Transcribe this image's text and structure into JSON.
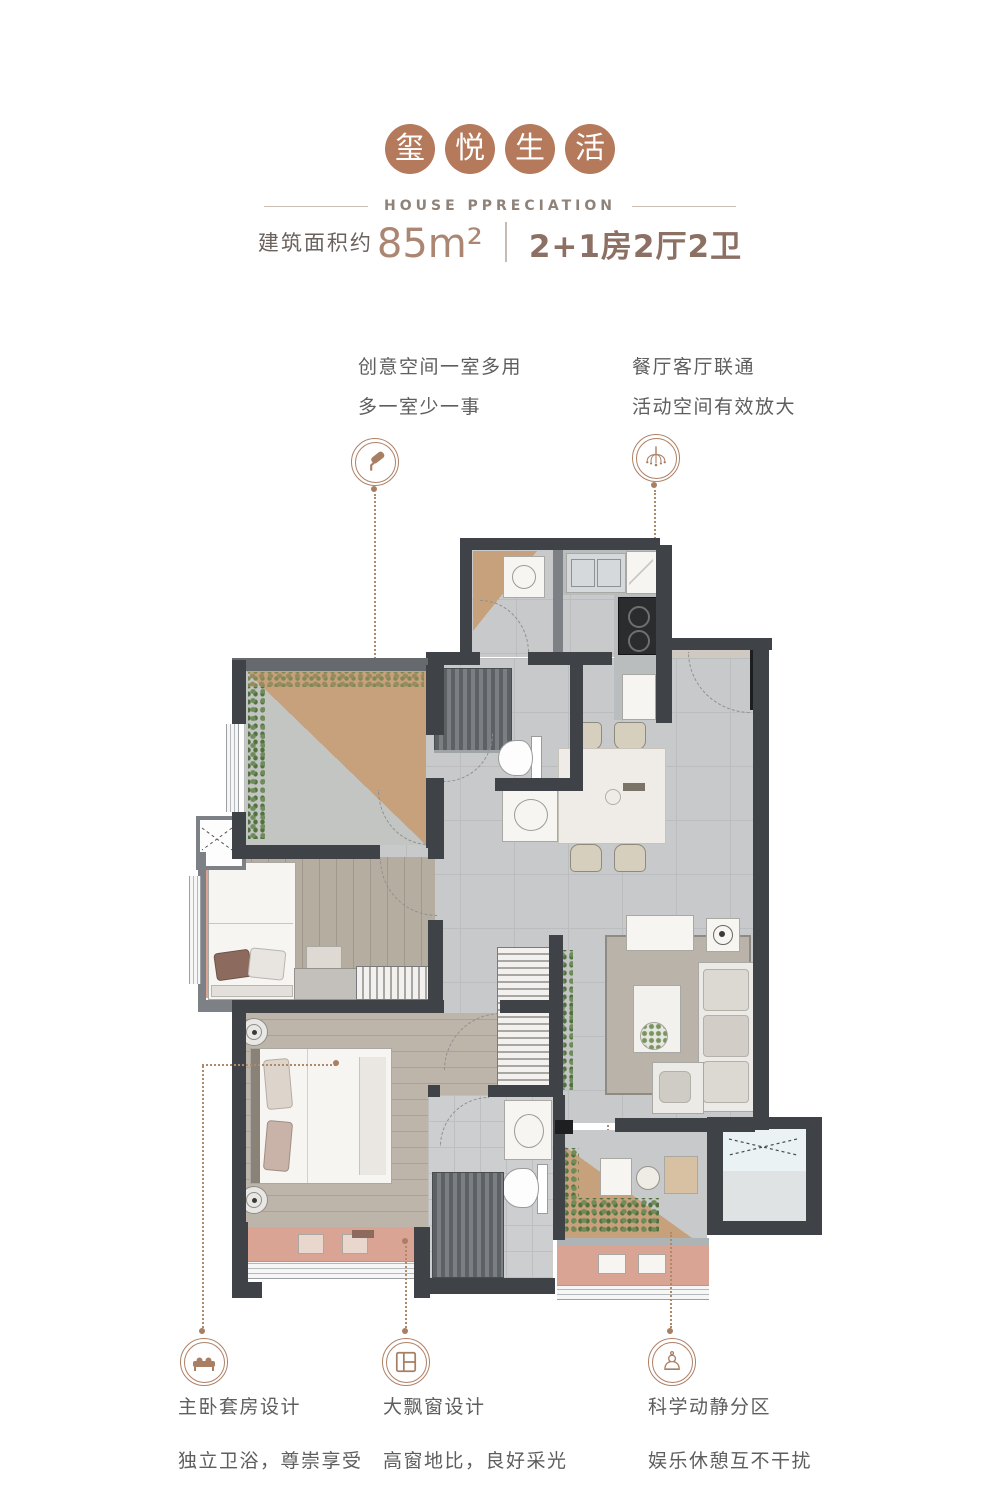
{
  "header": {
    "title_chars": [
      "玺",
      "悦",
      "生",
      "活"
    ],
    "subtitle": "HOUSE PPRECIATION",
    "area_label": "建筑面积约",
    "area_value": "85m²",
    "unit_layout": "2+1房2厅2卫",
    "brand_color": "#b5795b"
  },
  "callouts": {
    "flex_room": {
      "line1": "创意空间一室多用",
      "line2": "多一室少一事",
      "icon": "paint-roller-icon"
    },
    "dining_living": {
      "line1": "餐厅客厅联通",
      "line2": "活动空间有效放大",
      "icon": "chandelier-icon"
    },
    "master_suite": {
      "line1": "主卧套房设计",
      "line2": "独立卫浴，尊崇享受",
      "icon": "bed-icon"
    },
    "bay_window": {
      "line1": "大飘窗设计",
      "line2": "高窗地比，良好采光",
      "icon": "window-icon"
    },
    "zoning": {
      "line1": "科学动静分区",
      "line2": "娱乐休憩互不干扰",
      "icon": "chess-pawn-icon",
      "glyph": "♙"
    }
  },
  "colors": {
    "accent": "#b08968",
    "wall": "#3f4246",
    "tan": "#c7a17b",
    "salmon": "#d9a494",
    "floor_tile": "#c7c9ca",
    "wood": "#b6ada1"
  }
}
